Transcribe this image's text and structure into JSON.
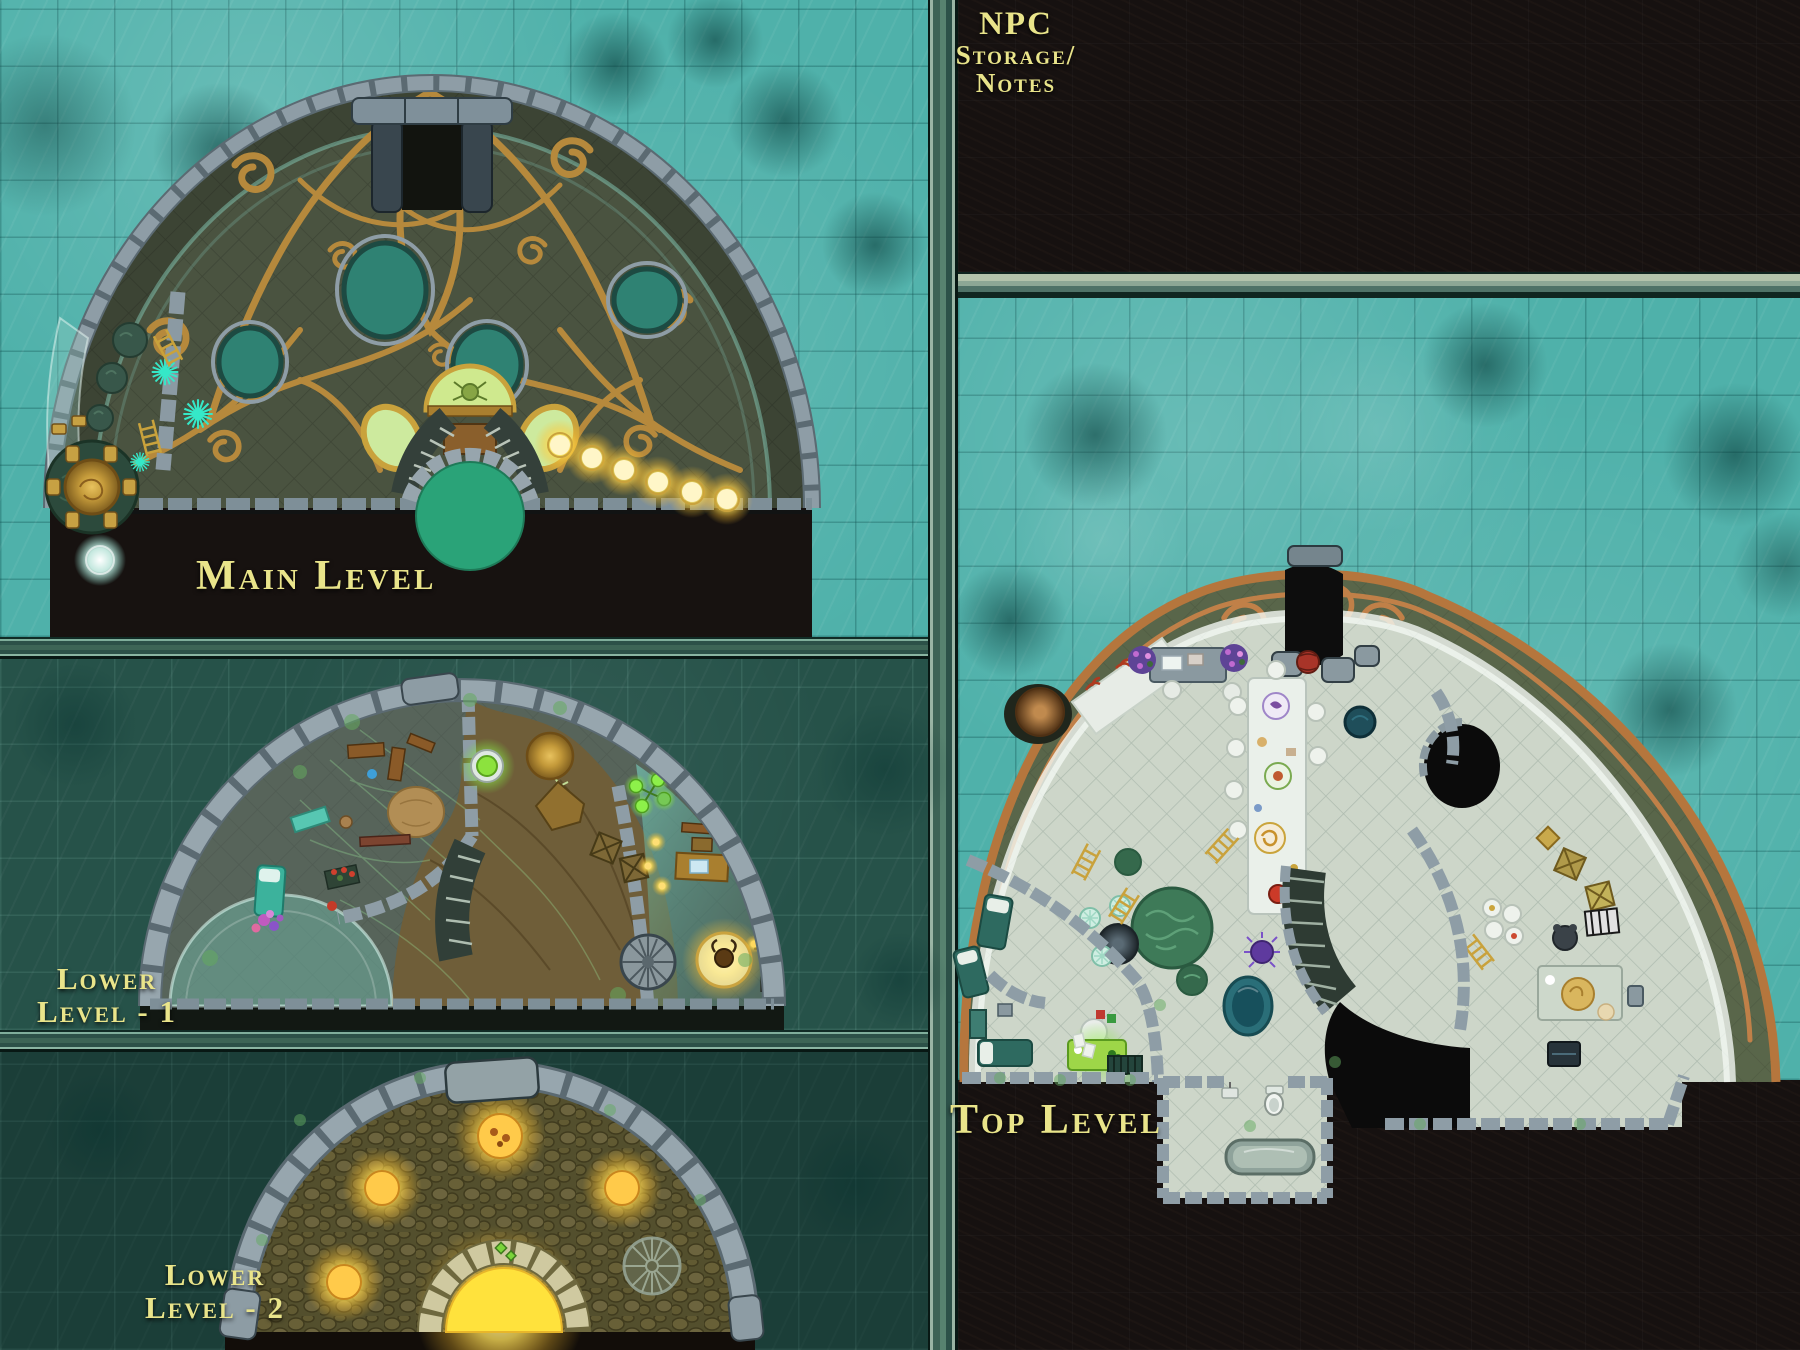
{
  "map": {
    "panels": {
      "main": {
        "label": "Main Level"
      },
      "lower1": {
        "label_line1": "Lower",
        "label_line2": "Level - 1"
      },
      "lower2": {
        "label_line1": "Lower",
        "label_line2": "Level - 2"
      },
      "top": {
        "label": "Top Level"
      },
      "npc": {
        "label_line1": "NPC",
        "label_line2": "Storage/",
        "label_line3": "Notes"
      }
    },
    "colors": {
      "water_bright": "#4fb1aa",
      "water_mid": "#265249",
      "water_dark": "#1b3e38",
      "void_black": "#161110",
      "label_yellow": "#e9e48a",
      "gold_filigree": "#b6893c",
      "copper": "#c08048",
      "stone_gray": "#8e9da6",
      "dome_olive": "#4a5340",
      "floor_pale": "#cdd6c9",
      "glow_yellow": "#ffe44d",
      "teal_porthole": "#2f8273",
      "green_platform": "#2aa378"
    },
    "features": {
      "main_level": [
        "gold-filigree-dome",
        "airlock-door",
        "portholes",
        "grand-staircase",
        "green-platform",
        "glow-lamps",
        "round-gold-table",
        "chairs",
        "coral-bushes",
        "spike-plants",
        "ladders",
        "glass-wall",
        "white-glow-orb"
      ],
      "lower_level_1": [
        "stone-block-dome",
        "moss-room",
        "spider-webs",
        "glowing-cauldron",
        "skeleton",
        "hide-rug",
        "wooden-racks",
        "wooden-coffin",
        "supply-crates",
        "writing-desk",
        "candles",
        "spiral-stair",
        "curved-stair",
        "glowing-brazier",
        "candelabra",
        "glass-bubble-room",
        "bed",
        "coral-flowers",
        "planter"
      ],
      "lower_level_2": [
        "stone-block-dome",
        "cobblestone-floor",
        "glowing-orbs",
        "glowing-arch-pit",
        "spiral-stair",
        "cap-stone"
      ],
      "top_level": [
        "copper-filigree-band",
        "entry-door",
        "dark-hole",
        "fur-ball",
        "white-glass-walkway",
        "red-coral",
        "writing-desk",
        "flower-planters",
        "banquet-table",
        "plates",
        "chairs",
        "brain-coral-garden",
        "reflecting-pool",
        "dark-sphere",
        "flower-tables",
        "beds",
        "nightstand",
        "green-glow-chest",
        "papers",
        "vent",
        "stairs-down",
        "black-pit",
        "kitchen-plates",
        "kettle",
        "dining-table",
        "gold-platter",
        "crates",
        "zebra-crate",
        "gold-plaque",
        "tv-cabinet",
        "bathroom",
        "bathtub",
        "toilet",
        "washbasin",
        "gold-ladders",
        "purple-creature",
        "white-sphere"
      ]
    }
  }
}
